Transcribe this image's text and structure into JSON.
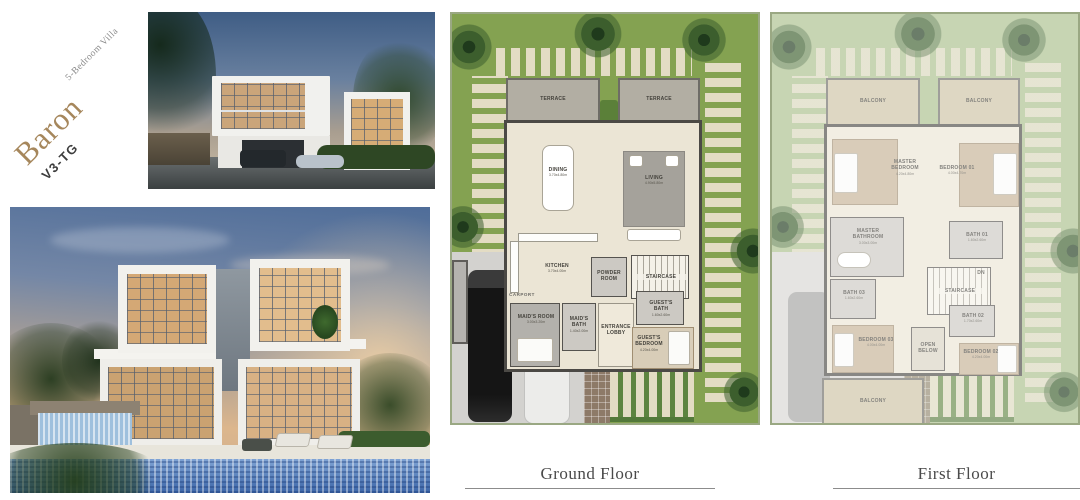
{
  "brand": {
    "name": "Baron",
    "code": "V3-TG",
    "subtitle": "5-Bedroom Villa"
  },
  "captions": {
    "ground": "Ground Floor",
    "first": "First Floor"
  },
  "palette": {
    "brand_gold": "#a6875c",
    "garden_green": "#84a251",
    "wall_gray": "#4b4945",
    "pool_blue": "#486fad"
  },
  "ground_floor": {
    "rooms": {
      "terrace_left": {
        "name": "TERRACE"
      },
      "terrace_right": {
        "name": "TERRACE"
      },
      "dining": {
        "name": "DINING",
        "dims": "3.70x4.80m"
      },
      "living": {
        "name": "LIVING",
        "dims": "4.90x5.80m"
      },
      "kitchen": {
        "name": "KITCHEN",
        "dims": "3.70x4.00m"
      },
      "powder": {
        "name": "POWDER ROOM"
      },
      "staircase": {
        "name": "STAIRCASE"
      },
      "maids_room": {
        "name": "MAID'S ROOM",
        "dims": "3.00x3.20m"
      },
      "maids_bath": {
        "name": "MAID'S BATH",
        "dims": "1.40x2.00m"
      },
      "entrance": {
        "name": "ENTRANCE LOBBY"
      },
      "guests_bath": {
        "name": "GUEST'S BATH",
        "dims": "1.60x2.60m"
      },
      "guests_bedroom": {
        "name": "GUEST'S BEDROOM",
        "dims": "4.20x4.00m"
      },
      "carport": {
        "name": "CARPORT"
      }
    }
  },
  "first_floor": {
    "rooms": {
      "balcony_left": {
        "name": "BALCONY"
      },
      "balcony_right": {
        "name": "BALCONY"
      },
      "master_bedroom": {
        "name": "MASTER BEDROOM",
        "dims": "4.20x4.80m"
      },
      "bedroom_01": {
        "name": "BEDROOM 01",
        "dims": "4.00x4.70m"
      },
      "master_bathroom": {
        "name": "MASTER BATHROOM",
        "dims": "3.00x3.00m"
      },
      "bath_01": {
        "name": "BATH 01",
        "dims": "1.60x2.60m"
      },
      "bath_03": {
        "name": "BATH 03",
        "dims": "1.60x2.60m"
      },
      "staircase": {
        "name": "STAIRCASE"
      },
      "dn": "DN",
      "bath_02": {
        "name": "BATH 02",
        "dims": "1.70x2.60m"
      },
      "bedroom_03": {
        "name": "BEDROOM 03",
        "dims": "4.00x4.00m"
      },
      "open_below": {
        "name": "OPEN BELOW"
      },
      "bedroom_02": {
        "name": "BEDROOM 02",
        "dims": "4.20x4.00m"
      },
      "balcony_bottom": {
        "name": "BALCONY"
      }
    }
  }
}
